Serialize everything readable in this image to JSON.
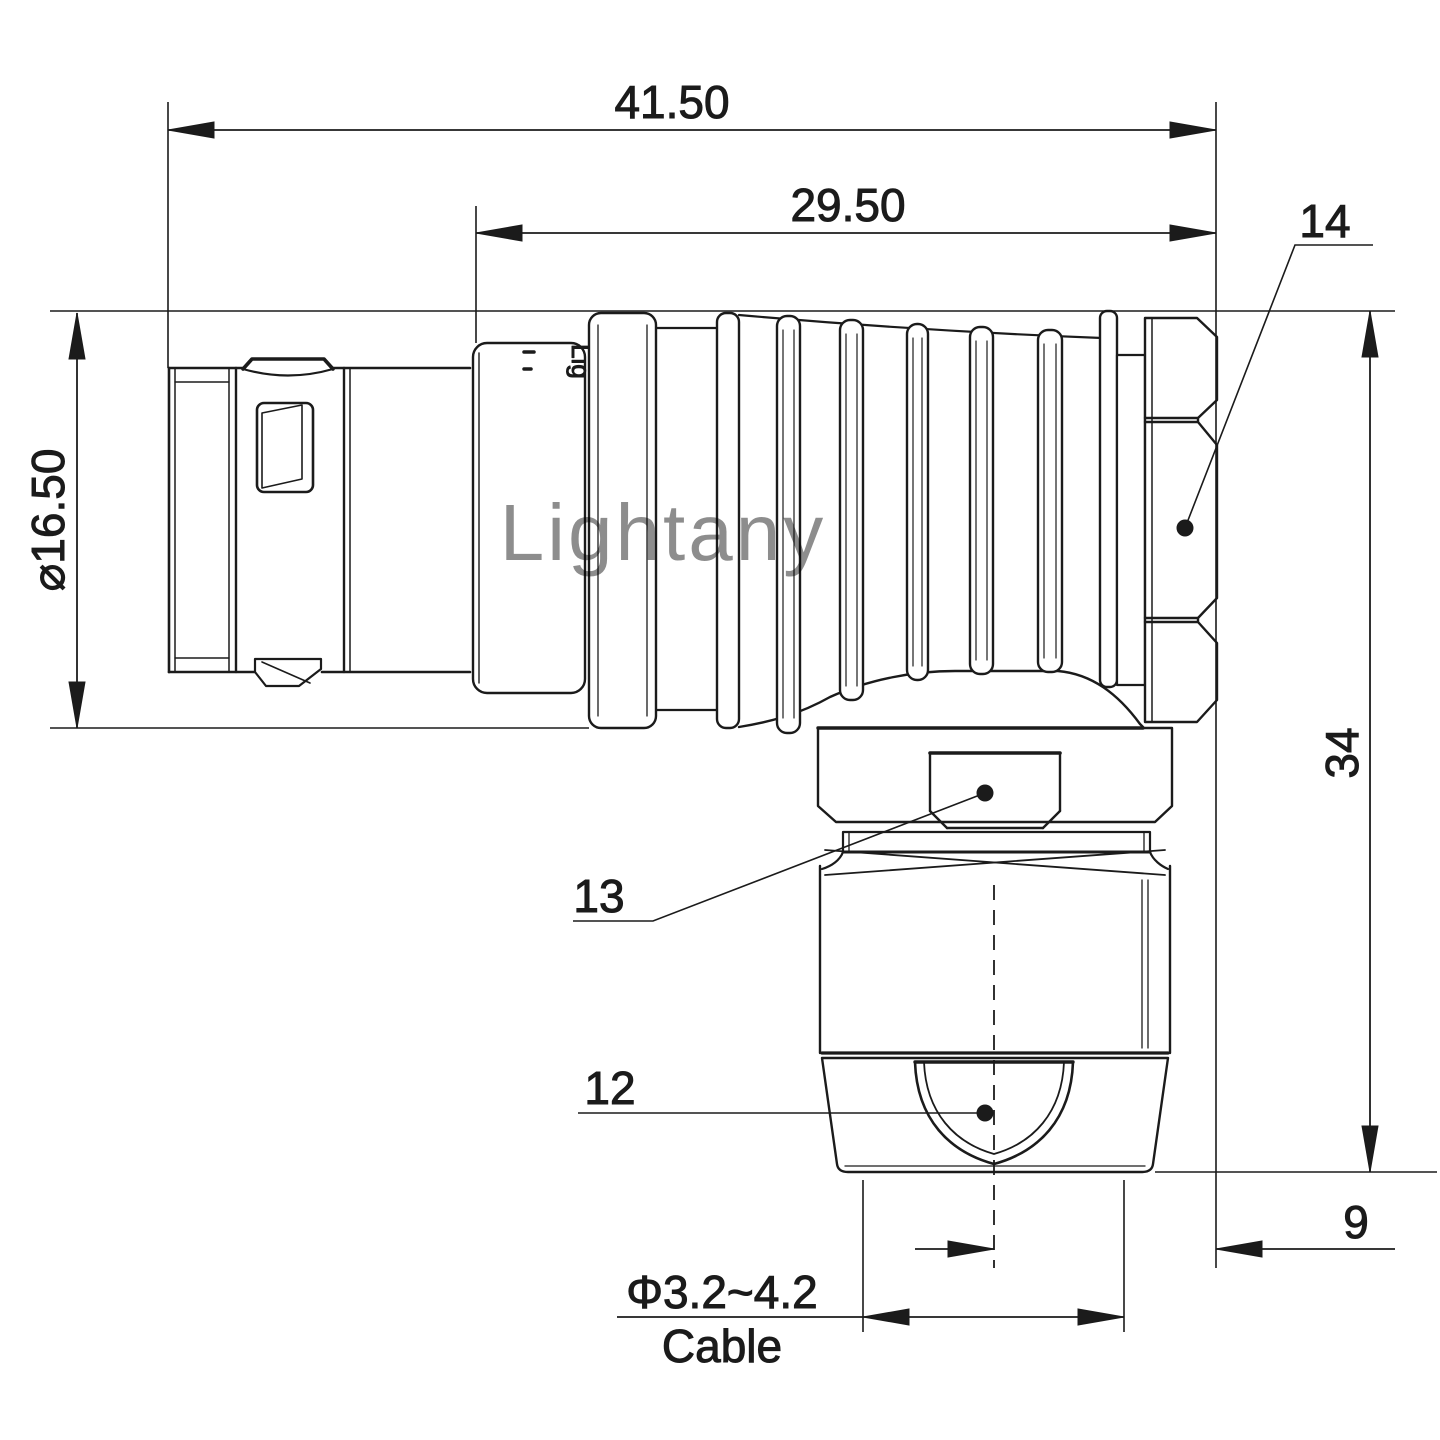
{
  "drawing": {
    "kind": "engineering-drawing",
    "subject": "right-angle push-pull circular connector, side elevation",
    "watermark": {
      "text": "Lightany",
      "color": "#e89c9c"
    },
    "engraving": {
      "text": "Lig"
    },
    "line_color": "#1b1b1b",
    "background": "#ffffff"
  },
  "dimensions": {
    "overall_length": {
      "value": "41.50"
    },
    "body_length": {
      "value": "29.50"
    },
    "shell_diameter": {
      "value": "⌀16.50"
    },
    "total_height": {
      "value": "34"
    },
    "axis_offset": {
      "value": "9"
    },
    "cable_diameter": {
      "value": "Φ3.2~4.2"
    },
    "cable_word": {
      "value": "Cable"
    }
  },
  "callouts": {
    "back_nut": {
      "label": "14"
    },
    "coupling_hex": {
      "label": "13"
    },
    "cable_clamp": {
      "label": "12"
    }
  }
}
